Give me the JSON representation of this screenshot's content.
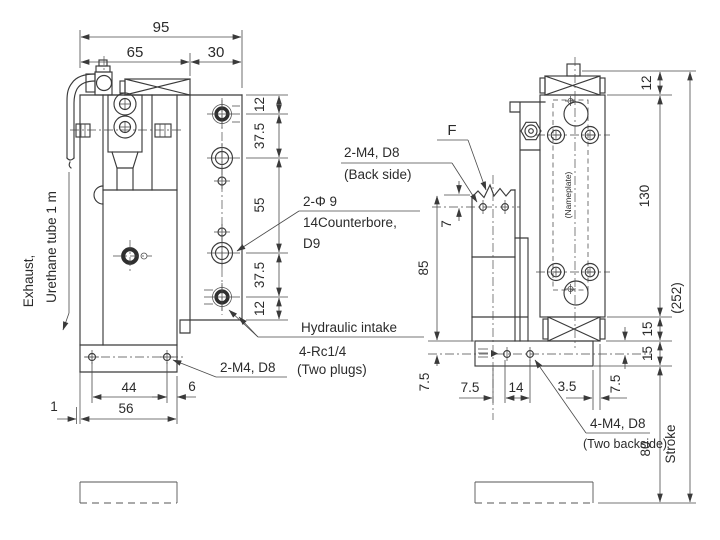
{
  "left_view": {
    "top_dims": {
      "overall": "95",
      "body": "65",
      "plate": "30"
    },
    "side_dims": {
      "s1": "12",
      "s2": "37.5",
      "s3": "55",
      "s4": "37.5",
      "s5": "12"
    },
    "bottom_dims": {
      "holes": "44",
      "edge": "6",
      "offset": "1",
      "base": "56"
    },
    "exhaust_label_1": "Exhaust,",
    "exhaust_label_2": "Urethane tube 1 m",
    "counterbore_1": "2-Φ 9",
    "counterbore_2": "14Counterbore,",
    "counterbore_3": "D9",
    "mount_label": "2-M4, D8",
    "intake_1": "Hydraulic intake",
    "intake_2": "4-Rc1/4",
    "intake_3": "(Two plugs)"
  },
  "right_view": {
    "f_label": "F",
    "back_mount_1": "2-M4, D8",
    "back_mount_2": "(Back side)",
    "nameplate": "(Nameplate)",
    "mount_1": "4-M4, D8",
    "mount_2": "(Two backside)",
    "stroke_label": "Stroke",
    "dims": {
      "top": "12",
      "body": "130",
      "xbox": "15",
      "base": "15",
      "hole_above": "7",
      "body_len": "85",
      "port_left": "7.5",
      "port_right": "7.5",
      "cl_offset": "7.5",
      "pitch": "14",
      "edge": "3.5",
      "stroke": "80",
      "overall": "(252)"
    }
  }
}
